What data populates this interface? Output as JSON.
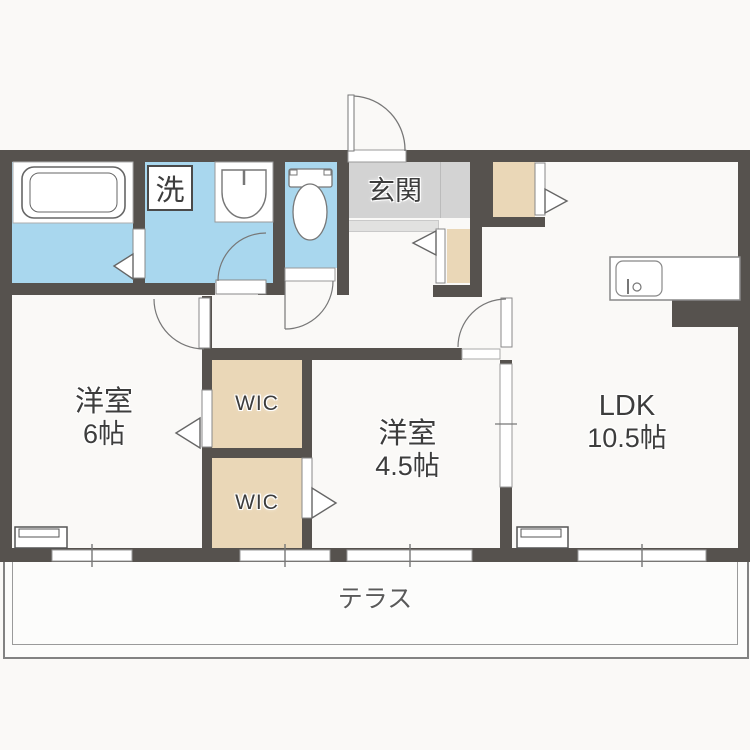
{
  "plan": {
    "type": "apartment-floor-plan",
    "colors": {
      "wall": "#56524e",
      "water-room": "#a9d7ee",
      "closet": "#ead7b7",
      "entry": "#d3d3d3",
      "entry-step": "#e1e1e0",
      "line": "#777777",
      "text": "#3d3d3d",
      "bg": "#faf9f7"
    },
    "rooms": {
      "entry": {
        "label": "玄関"
      },
      "laundry": {
        "label": "洗"
      },
      "bedroom1": {
        "name": "洋室",
        "size": "6帖"
      },
      "bedroom2": {
        "name": "洋室",
        "size": "4.5帖"
      },
      "ldk": {
        "name": "LDK",
        "size": "10.5帖"
      },
      "wic_upper": {
        "label": "WIC"
      },
      "wic_lower": {
        "label": "WIC"
      },
      "terrace": {
        "label": "テラス"
      }
    }
  }
}
